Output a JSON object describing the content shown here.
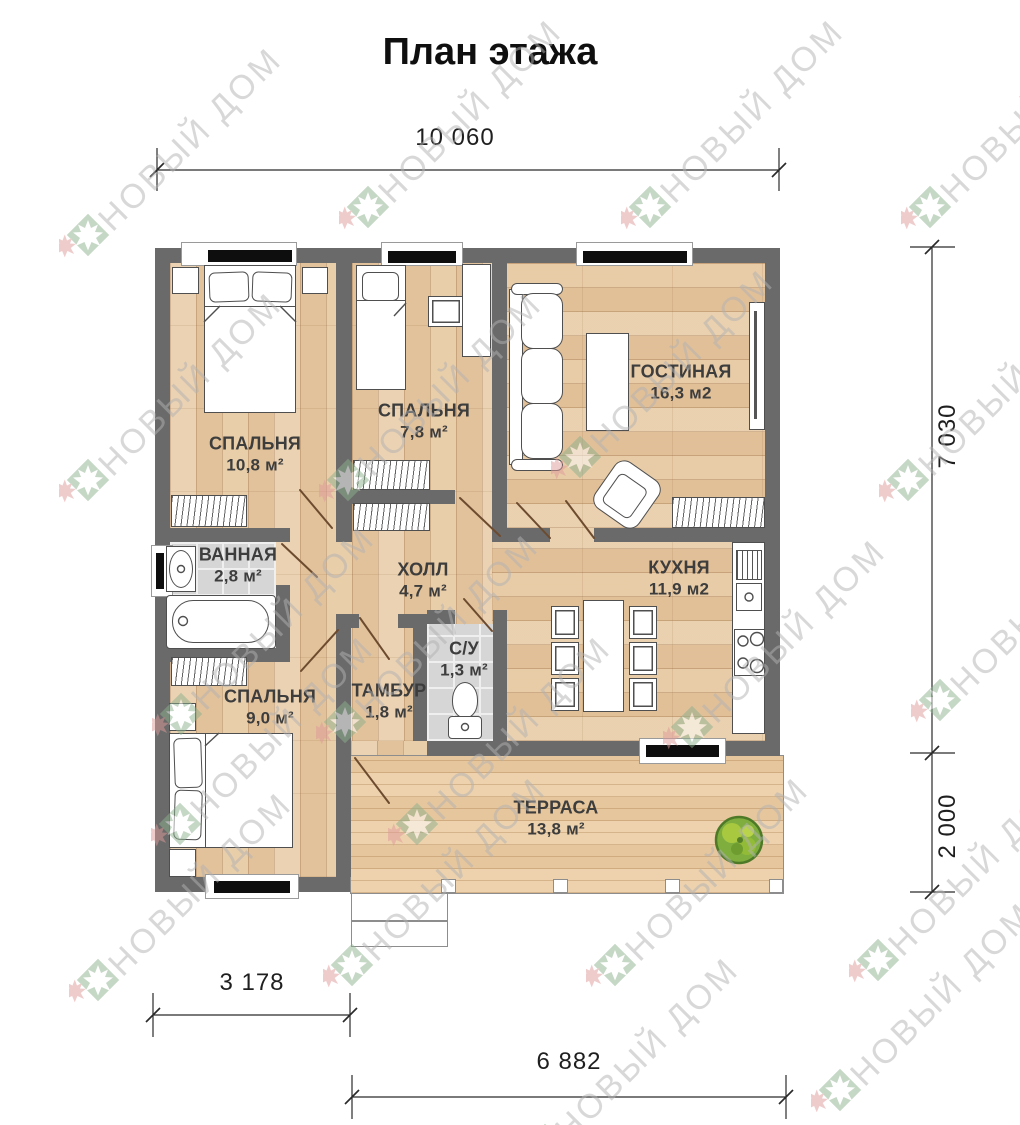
{
  "title": "План этажа",
  "watermark": {
    "text": "НОВЫЙ ДОМ"
  },
  "dimensions": {
    "top": "10 060",
    "right_upper": "7 030",
    "right_lower": "2 000",
    "bottom_left": "3 178",
    "bottom": "6 882"
  },
  "rooms": [
    {
      "name": "СПАЛЬНЯ",
      "area": "10,8 м²"
    },
    {
      "name": "СПАЛЬНЯ",
      "area": "7,8 м²"
    },
    {
      "name": "ГОСТИНАЯ",
      "area": "16,3 м2"
    },
    {
      "name": "ВАННАЯ",
      "area": "2,8 м²"
    },
    {
      "name": "ХОЛЛ",
      "area": "4,7 м²"
    },
    {
      "name": "КУХНЯ",
      "area": "11,9 м2"
    },
    {
      "name": "СПАЛЬНЯ",
      "area": "9,0 м²"
    },
    {
      "name": "ТАМБУР",
      "area": "1,8 м²"
    },
    {
      "name": "С/У",
      "area": "1,3 м²"
    },
    {
      "name": "ТЕРРАСА",
      "area": "13,8 м²"
    }
  ],
  "colors": {
    "wall": "#6a6a6a",
    "floor_wood": "#e8cba5",
    "floor_tile": "#d6d6d6",
    "terrace": "#ebcda4",
    "logo_green": "#8cb08d",
    "logo_red": "#e09a9a",
    "watermark_text": "#b2b2b2",
    "dimension_text": "#1f1f1f",
    "room_label": "#3d3d3d"
  }
}
